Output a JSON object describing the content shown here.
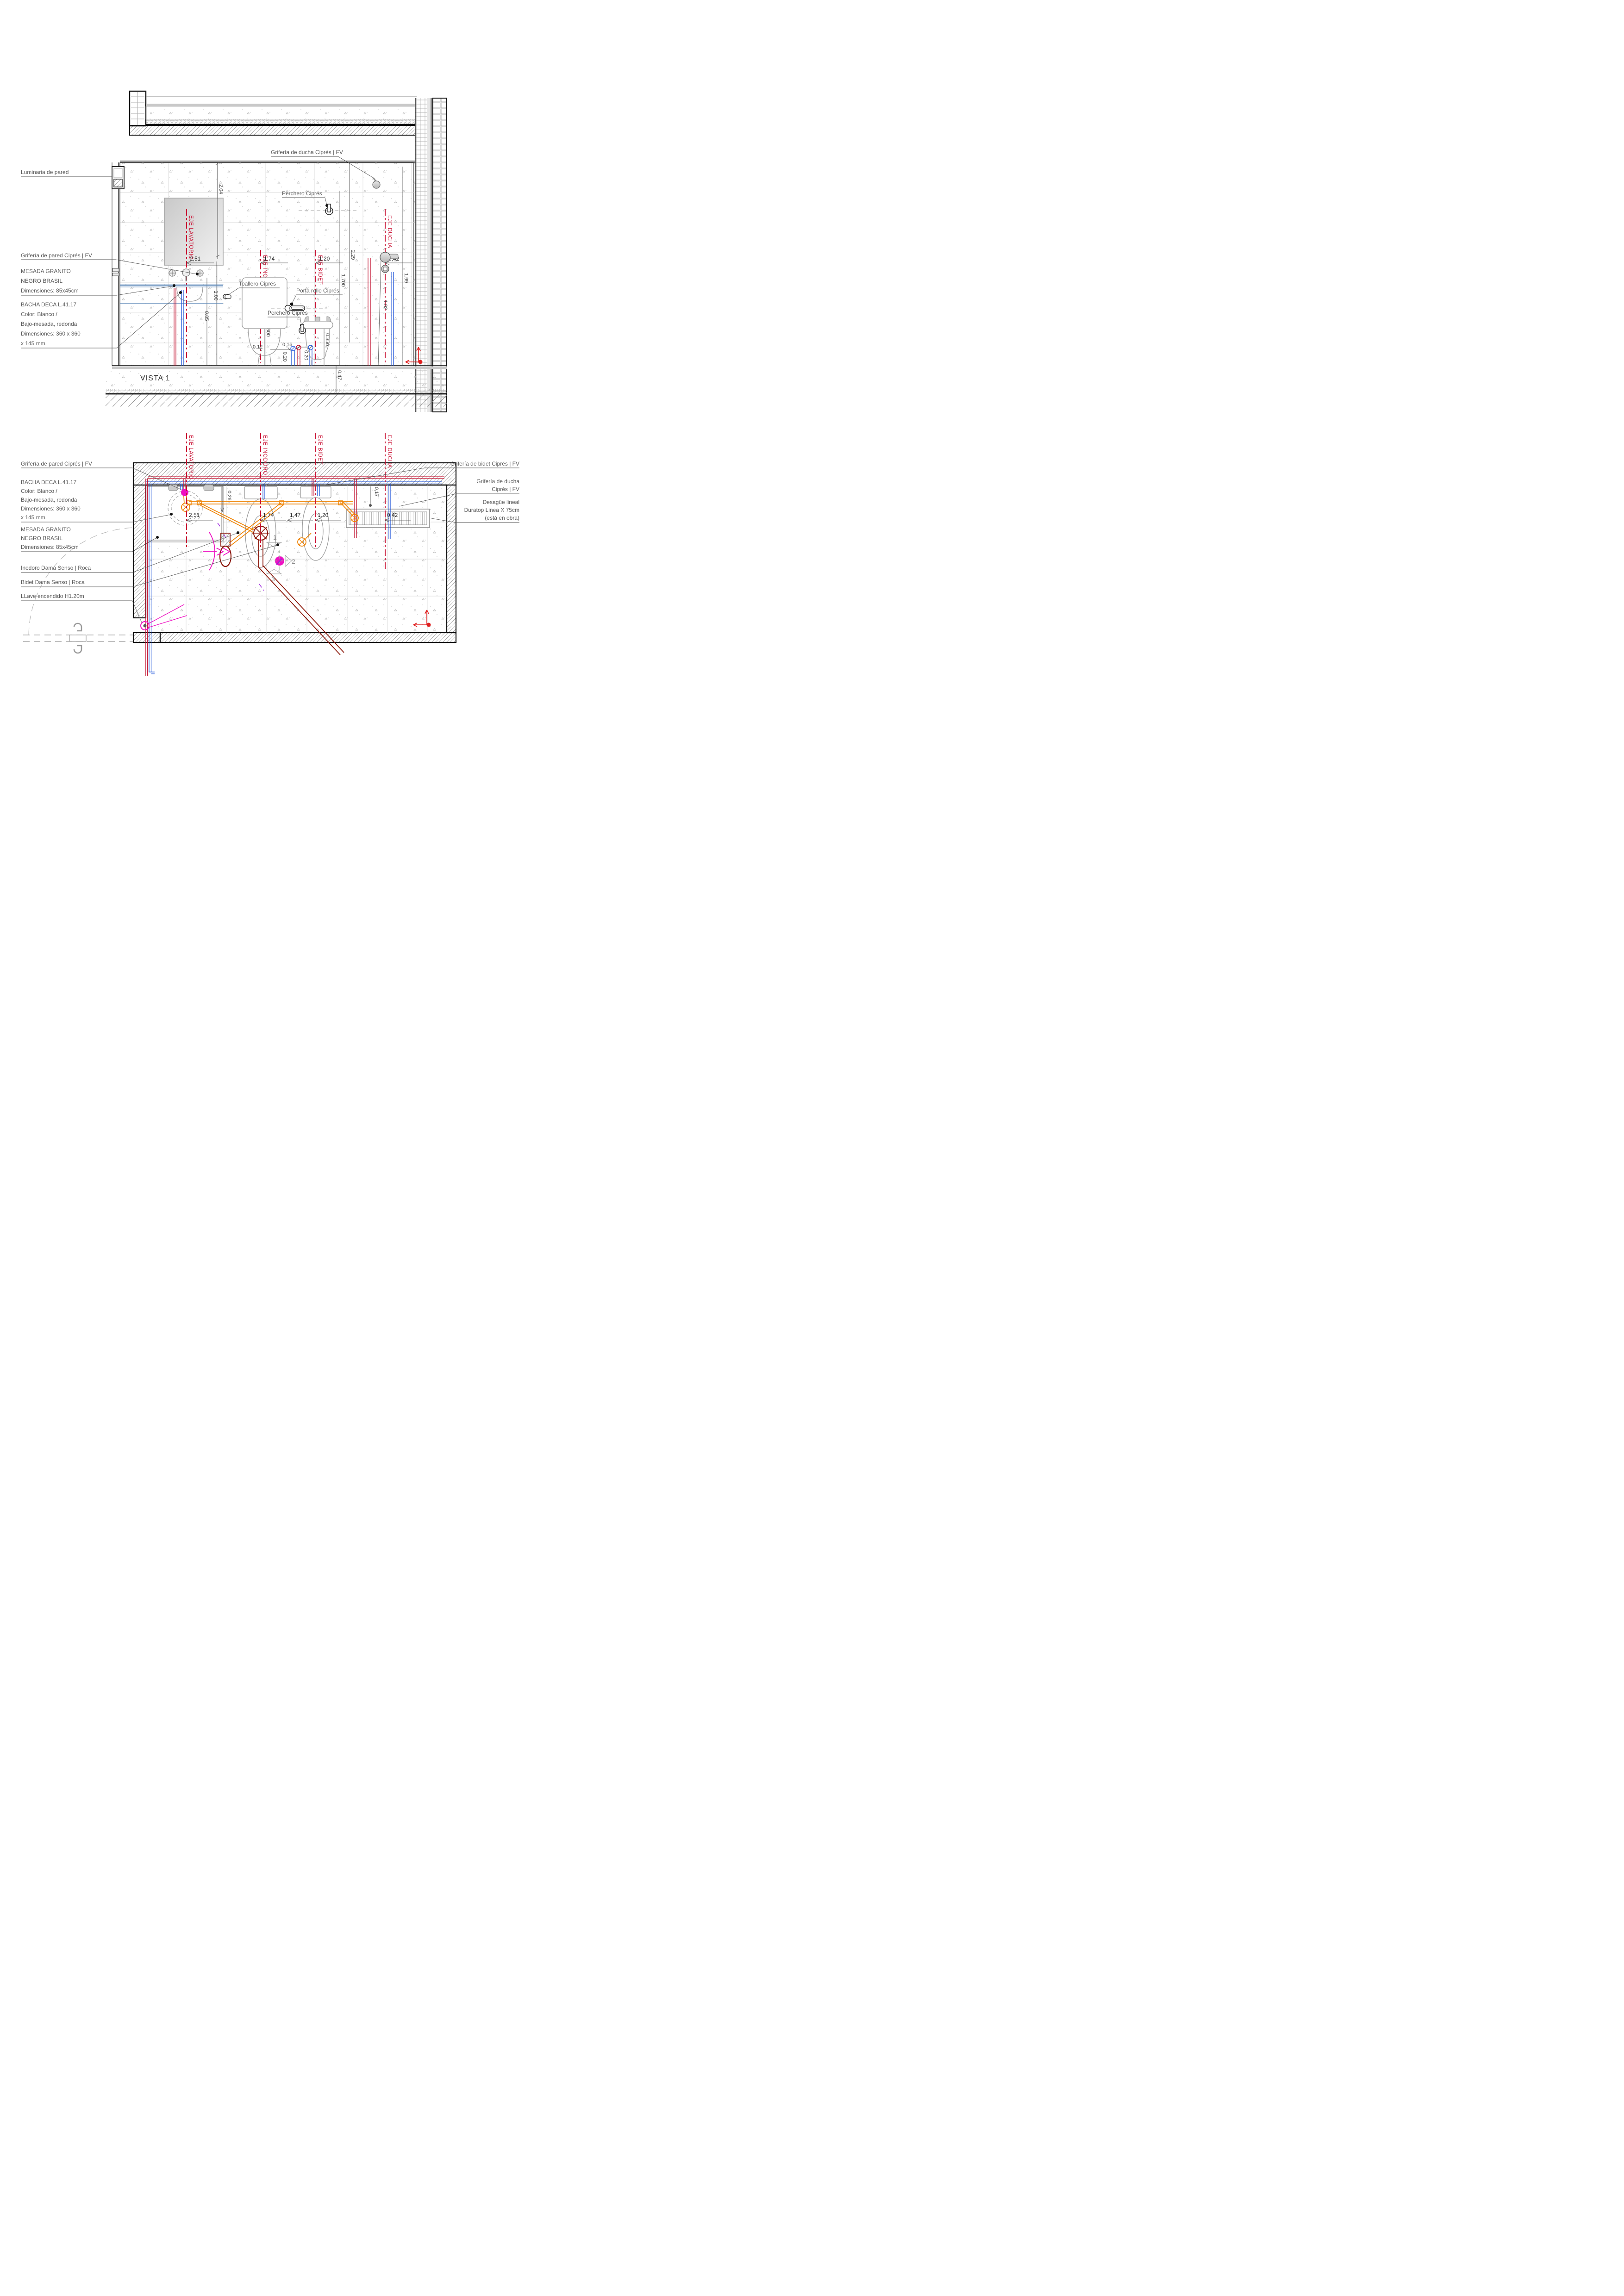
{
  "title": "VISTA 1",
  "colors": {
    "axis_red": "#c91335",
    "hot_pipe_red": "#c41432",
    "cold_pipe_blue": "#2156d9",
    "drain_orange": "#ef8200",
    "waste_maroon": "#8a1507",
    "magenta": "#ee10c2",
    "label_gray": "#595959"
  },
  "axes": {
    "lavatorio": "EJE LAVATORIO",
    "inodoro": "EJE INODORO",
    "bidet": "EJE BIDET",
    "ducha": "EJE DUCHA"
  },
  "elevation": {
    "labels": {
      "luminaria": "Luminaria de pared",
      "griferia_ducha": "Grifería de ducha Ciprés | FV",
      "perchero_top": "Perchero Ciprés",
      "griferia_pared": "Grifería de pared Ciprés | FV",
      "mesada": [
        "MESADA GRANITO",
        "NEGRO BRASIL",
        "Dimensiones: 85x45cm"
      ],
      "bacha": [
        "BACHA DECA L.41.17",
        "Color: Blanco /",
        "Bajo-mesada, redonda",
        "Dimensiones: 360 x 360",
        "x 145 mm."
      ],
      "toallero": "Toallero Ciprés",
      "porta_rollo": "Porta rollo Ciprés",
      "perchero_2": "Perchero Ciprés"
    },
    "dims": {
      "h": [
        "2,51",
        "1,74",
        "1,20",
        "0,42"
      ],
      "v": [
        "2.04",
        "2.29",
        "1.99",
        "1.700",
        "1.02",
        "1.00",
        "0.85",
        "0.600",
        "0.350",
        "0.47"
      ],
      "s": [
        "0.12",
        "0.20",
        "0.16",
        "0.20"
      ]
    }
  },
  "plan": {
    "labels_left": {
      "griferia_pared": "Grifería de pared Ciprés | FV",
      "bacha": [
        "BACHA DECA L.41.17",
        "Color: Blanco /",
        "Bajo-mesada, redonda",
        "Dimensiones: 360 x 360",
        "x 145 mm."
      ],
      "mesada": [
        "MESADA GRANITO",
        "NEGRO BRASIL",
        "Dimensiones: 85x45cm"
      ],
      "inodoro": "Inodoro Dama Senso | Roca",
      "bidet": "Bidet Dama Senso | Roca",
      "llave": "LLave encendido H1.20m"
    },
    "labels_right": {
      "griferia_bidet": "Grifería de bidet Ciprés | FV",
      "griferia_ducha": [
        "Grifería de ducha",
        "Ciprés | FV"
      ],
      "desague": [
        "Desagüe lineal",
        "Duratop Linea X 75cm",
        "(está en obra)"
      ]
    },
    "dims": {
      "h": [
        "2,51",
        "1,74",
        "1,47",
        "1,20",
        "0,42"
      ],
      "v": [
        "0,26",
        "0,17"
      ]
    },
    "markers": [
      "1",
      "2",
      "3"
    ]
  }
}
